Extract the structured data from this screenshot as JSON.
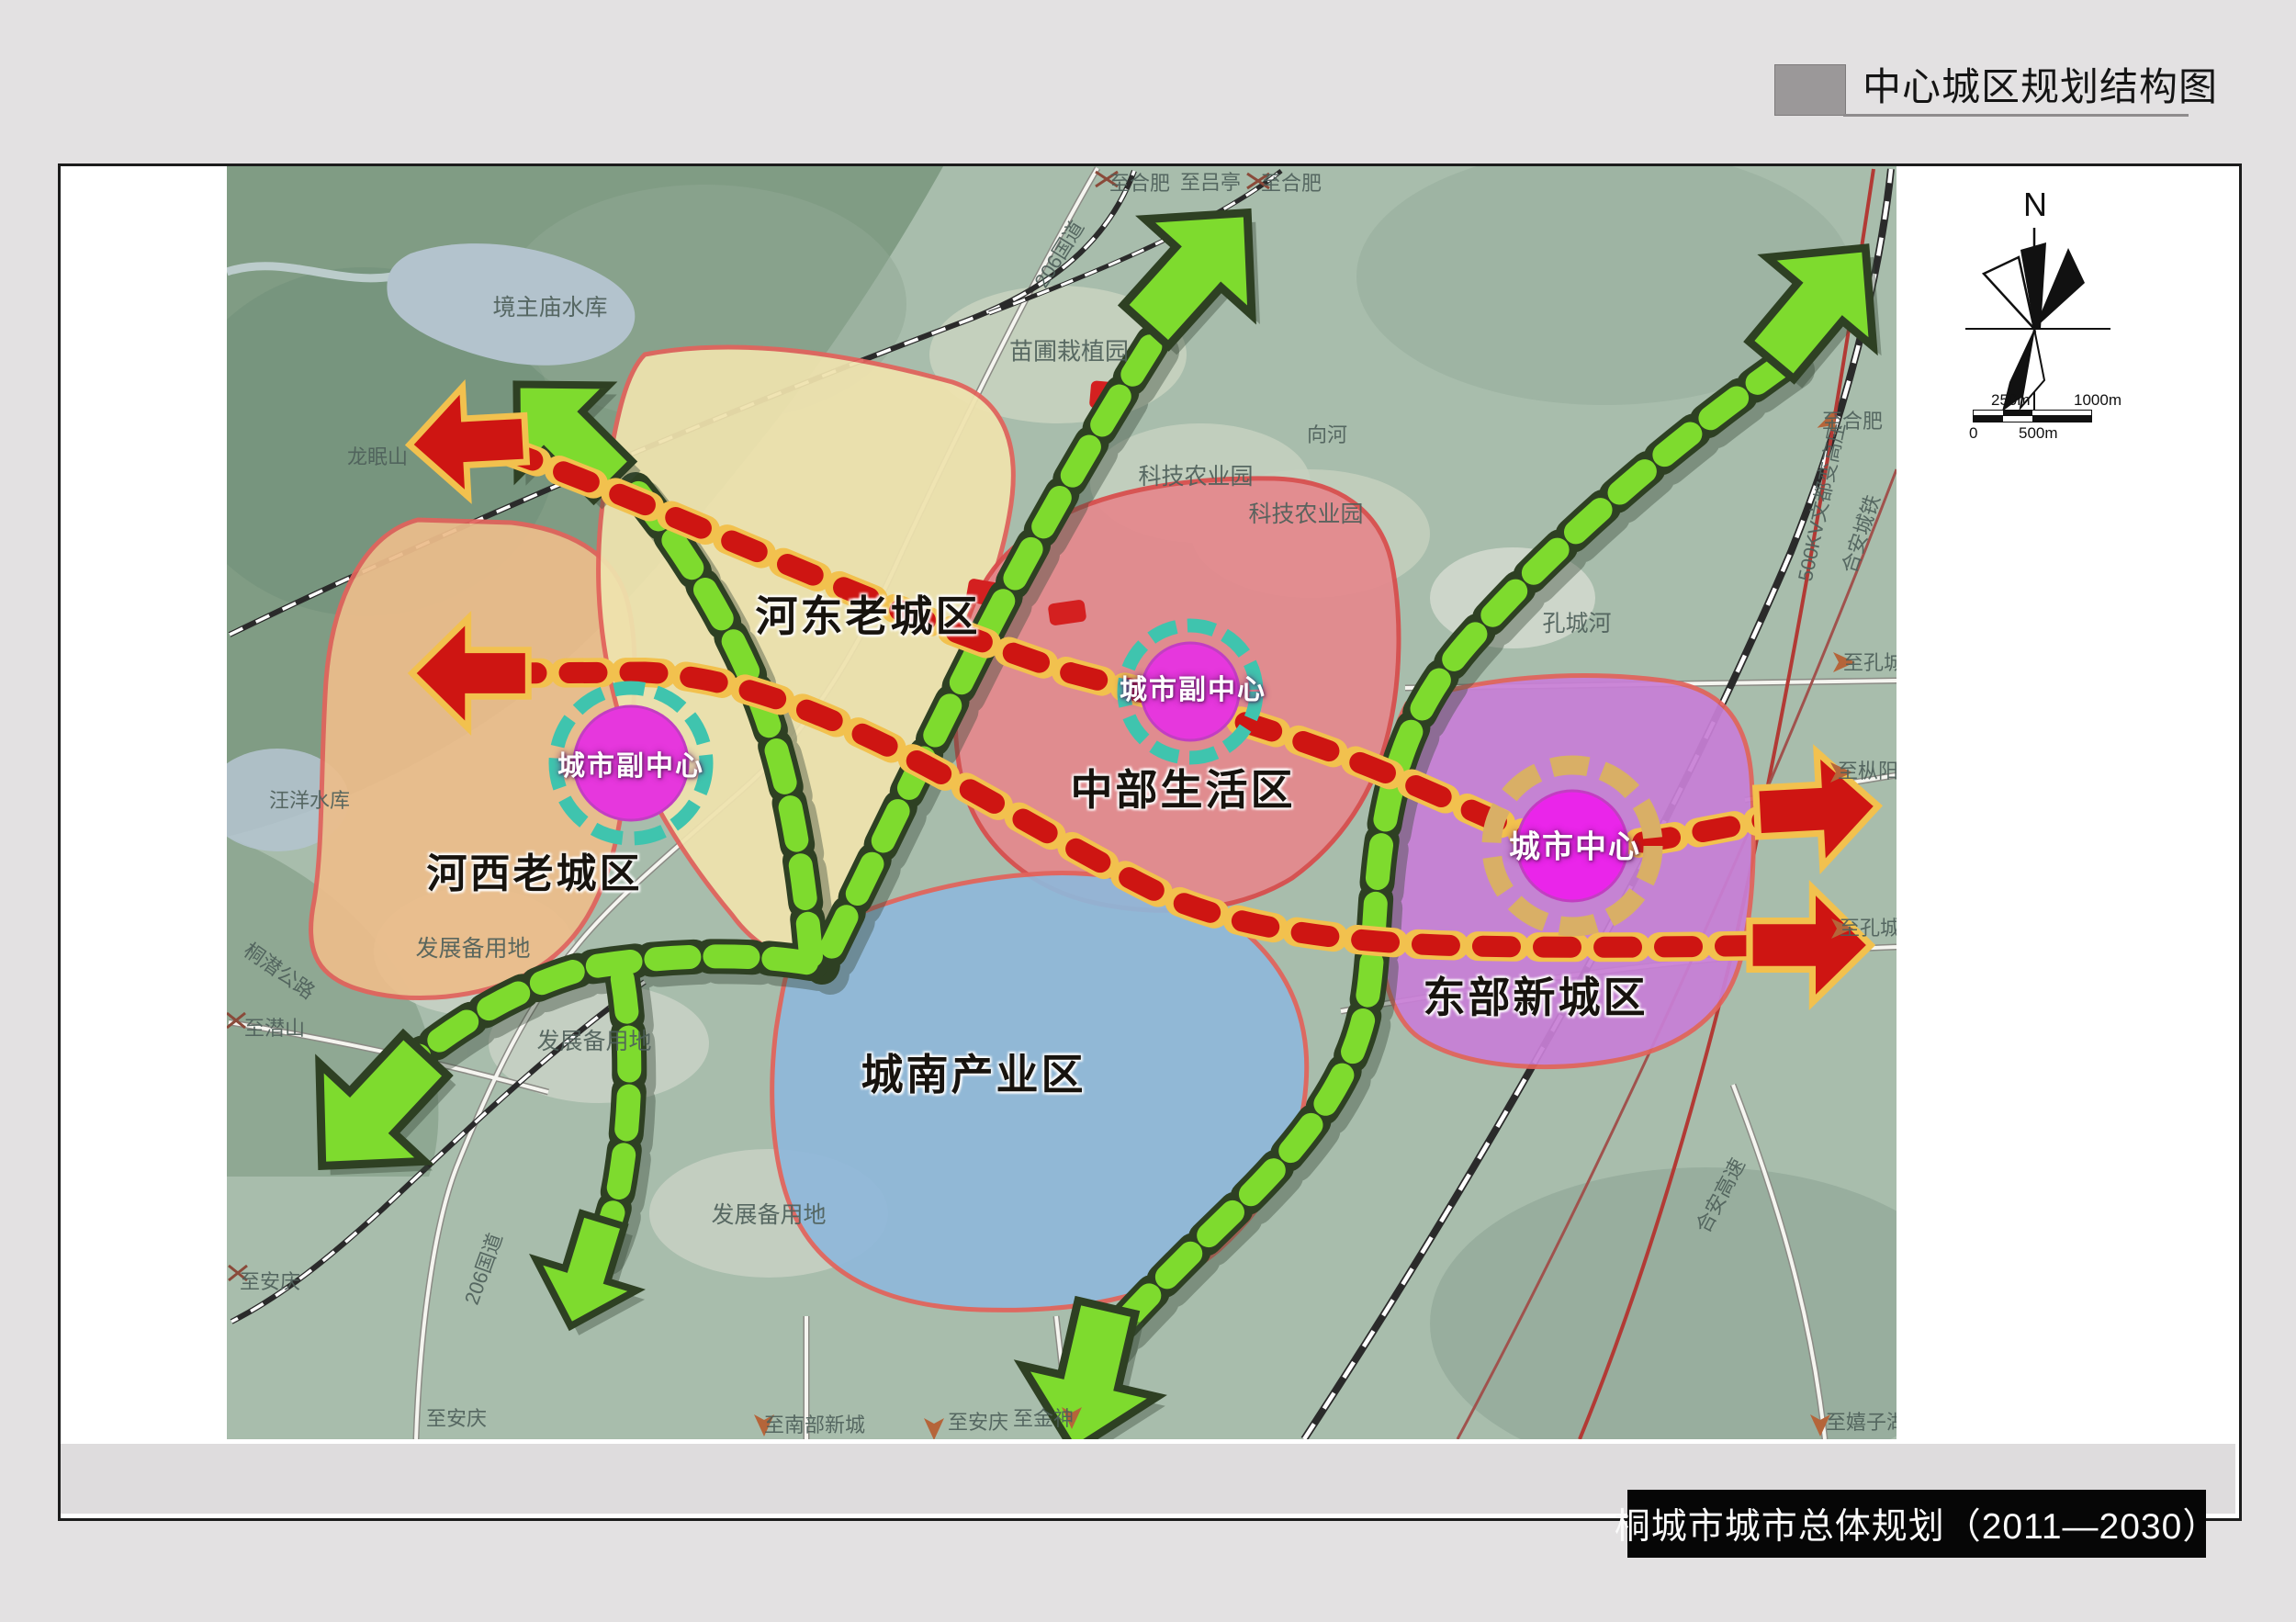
{
  "header": {
    "title": "中心城区规划结构图"
  },
  "footer": {
    "title": "桐城市城市总体规划（2011—2030）"
  },
  "compass": {
    "north_label": "N"
  },
  "scale_bar": {
    "top_left": "250m",
    "top_right": "1000m",
    "bottom_left": "0",
    "bottom_mid": "500m"
  },
  "zones": [
    {
      "name": "河东老城区",
      "fill": "#efe3ae"
    },
    {
      "name": "河西老城区",
      "fill": "#ecbd8b"
    },
    {
      "name": "中部生活区",
      "fill": "#e5898d"
    },
    {
      "name": "城南产业区",
      "fill": "#90b8da"
    },
    {
      "name": "东部新城区",
      "fill": "#c87fd6"
    }
  ],
  "centers": [
    {
      "label": "城市副中心"
    },
    {
      "label": "城市副中心"
    },
    {
      "label": "城市中心"
    }
  ],
  "colors": {
    "center_fill": "#e637dd",
    "ring_teal": "#3fc4ae",
    "ring_tan": "#d9af66",
    "axis_green": "#7edb2e",
    "axis_green_outline": "#2e4023",
    "axis_red": "#ce1512",
    "axis_red_outline": "#f2c14e"
  },
  "map_labels": [
    {
      "text": "至合肥"
    },
    {
      "text": "至吕亭"
    },
    {
      "text": "至合肥"
    },
    {
      "text": "206国道"
    },
    {
      "text": "苗圃栽植园"
    },
    {
      "text": "向河"
    },
    {
      "text": "科技农业园"
    },
    {
      "text": "科技农业园"
    },
    {
      "text": "境主庙水库"
    },
    {
      "text": "龙眠山"
    },
    {
      "text": "汪洋水库"
    },
    {
      "text": "孔城河"
    },
    {
      "text": "500KV文都变高压"
    },
    {
      "text": "合安城铁"
    },
    {
      "text": "至孔城"
    },
    {
      "text": "至枞阳"
    },
    {
      "text": "至孔城"
    },
    {
      "text": "至合肥"
    },
    {
      "text": "发展备用地"
    },
    {
      "text": "发展备用地"
    },
    {
      "text": "发展备用地"
    },
    {
      "text": "至潜山"
    },
    {
      "text": "桐潜公路"
    },
    {
      "text": "至安庆"
    },
    {
      "text": "206国道"
    },
    {
      "text": "至安庆"
    },
    {
      "text": "至南部新城"
    },
    {
      "text": "至安庆"
    },
    {
      "text": "至金神"
    },
    {
      "text": "至嬉子湖"
    },
    {
      "text": "合安高速"
    }
  ]
}
